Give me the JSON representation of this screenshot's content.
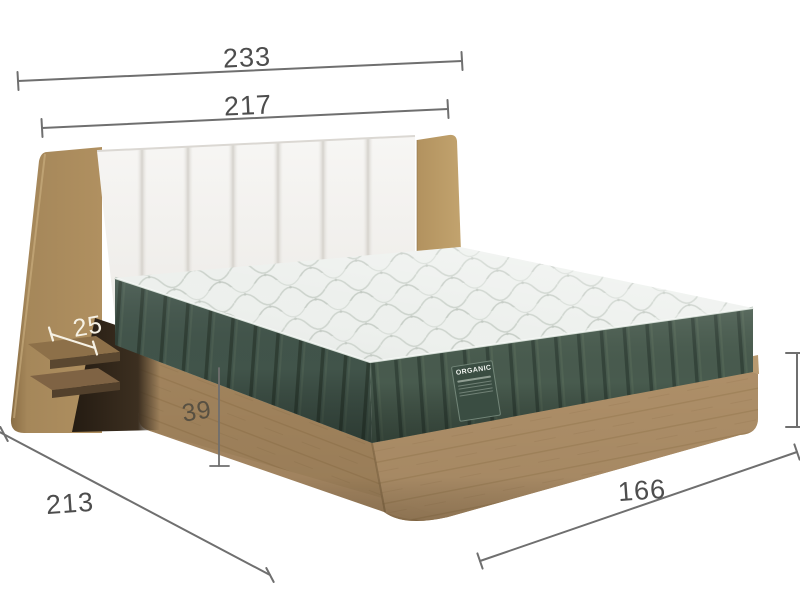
{
  "product": {
    "label": "ORGANIC"
  },
  "dimensions": [
    {
      "id": "outer-width",
      "value": "233"
    },
    {
      "id": "inner-width",
      "value": "217"
    },
    {
      "id": "shelf-depth",
      "value": "25"
    },
    {
      "id": "base-height",
      "value": "39"
    },
    {
      "id": "side-length",
      "value": "213"
    },
    {
      "id": "foot-width",
      "value": "166"
    }
  ],
  "colors": {
    "background": "#ffffff",
    "dimension_line": "#6f6f6f",
    "dimension_text": "#4d4d4d",
    "light_dimension_text": "#f6f1e4",
    "wood_frame": "#a98a64",
    "wood_wing_dark": "#8f7349",
    "mattress_side_green": "#45584b",
    "mattress_top": "#eef1ee",
    "headboard_white": "#f6f5f3"
  }
}
